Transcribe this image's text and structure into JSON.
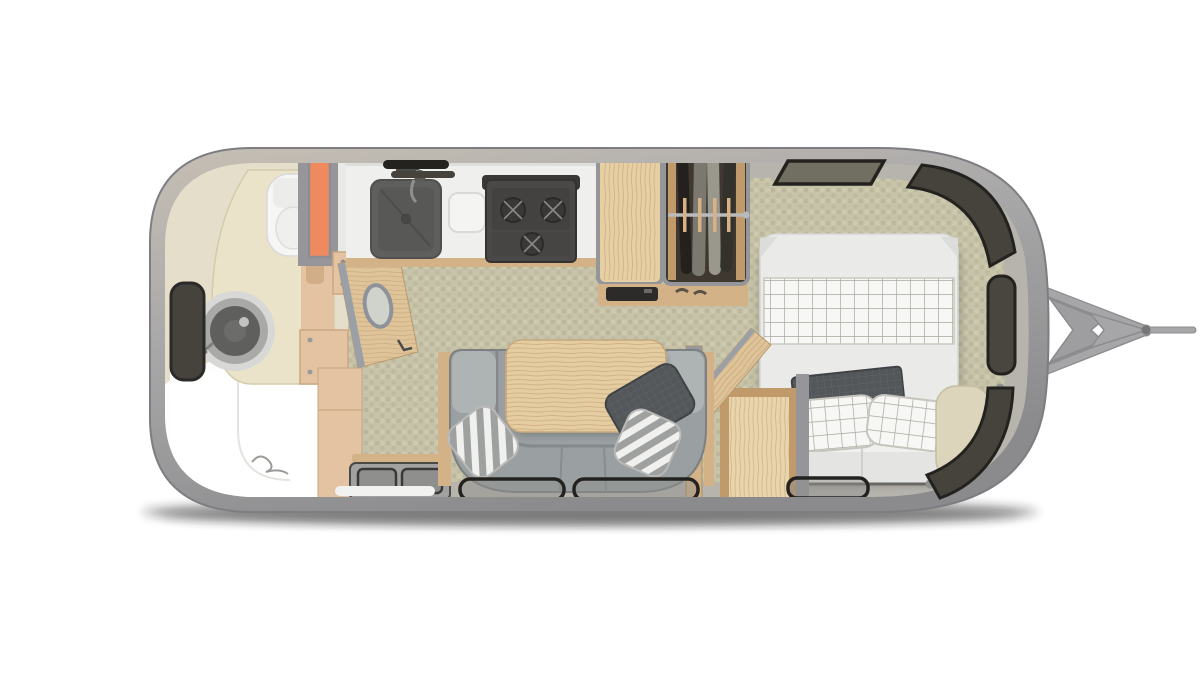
{
  "app": {
    "name": "travel-trailer-floor-plan",
    "description": "Top-down rendered floor plan of a travel trailer: rear bathroom (left), galley kitchen, wardrobe, U-shaped dinette, front bedroom (right) and A-frame hitch tongue pointing right. No text is rendered in the image."
  },
  "colors": {
    "background": "#ffffff",
    "shadow": "#141414",
    "shell_light": "#c6bfb4",
    "shell_mid": "#a3a2a3",
    "shell_dark": "#8b8b8d",
    "shell_rim": "#7d7d82",
    "wall_band": "#b7b4ae",
    "floor_base": "#c6c3a8",
    "floor_dot": "#b8b59a",
    "bathroom_floor": "#e5decb",
    "vanity_marble": "#eae3c9",
    "cabinet_tan": "#e3c3a2",
    "fixture_white": "#f6f6f4",
    "shower_white": "#ffffff",
    "orange_accent": "#ee8a5e",
    "wall_gray": "#95959a",
    "wood_light": "#e7cfa4",
    "wood_mid": "#d3b287",
    "wood_door": "#dfc49a",
    "wood_dark": "#c09a6a",
    "counter_white": "#efefed",
    "sink_dark": "#5f5f5d",
    "appliance_dark": "#4b4947",
    "stove_dark": "#444240",
    "window_dark": "#45433c",
    "window_frame": "#23221f",
    "window_pane": "#716f62",
    "sofa_gray": "#9aa0a1",
    "sofa_light": "#aeb3b4",
    "sofa_line": "#7c8082",
    "table_wood": "#e5cda2",
    "pillow_dark": "#54575a",
    "bed_white": "#eaebe9",
    "bed_trim": "#d4d5d3",
    "cushion_cream": "#dcd5bb",
    "step_gray": "#a2a2a0",
    "step_line": "#3a3a38",
    "handle_white": "#f2f2f0",
    "hitch_gray": "#a6a6a8",
    "hitch_dark": "#8c8c8e",
    "wardrobe_dark": "#3f3831",
    "rod_gray": "#b9babc"
  },
  "floorplan": {
    "orientation": "front-of-trailer-right",
    "rooms": [
      {
        "name": "rear-bathroom",
        "items": [
          "shower",
          "round-vanity-sink",
          "vanity-counter",
          "toilet",
          "wall-mirror-window",
          "orange-linen-niche",
          "bathroom-door-open"
        ]
      },
      {
        "name": "galley-kitchen",
        "items": [
          "counter",
          "kitchen-sink",
          "faucet",
          "cutting-board",
          "three-burner-cooktop",
          "refrigerator-wood-top",
          "vent-grille"
        ]
      },
      {
        "name": "wardrobe",
        "items": [
          "hanging-clothes",
          "closet-rod"
        ]
      },
      {
        "name": "dinette",
        "items": [
          "u-shaped-sofa",
          "wood-table",
          "striped-pillow-left",
          "striped-pillow-right",
          "dark-pillow"
        ]
      },
      {
        "name": "entry",
        "items": [
          "entry-step",
          "grab-handle",
          "threshold"
        ]
      },
      {
        "name": "bedroom-closet",
        "items": [
          "closet-box",
          "closet-door-open",
          "coat-hooks"
        ]
      },
      {
        "name": "front-bedroom",
        "items": [
          "bed",
          "checkered-blanket",
          "checkered-pillow-left",
          "checkered-pillow-right",
          "tv-panel",
          "white-bolster",
          "headboard-cushion"
        ]
      },
      {
        "name": "exterior",
        "items": [
          "a-frame-hitch",
          "coupler",
          "tongue-rod",
          "wraparound-windows",
          "belt-line-windows",
          "ground-shadow"
        ]
      }
    ],
    "window_count": 9
  }
}
